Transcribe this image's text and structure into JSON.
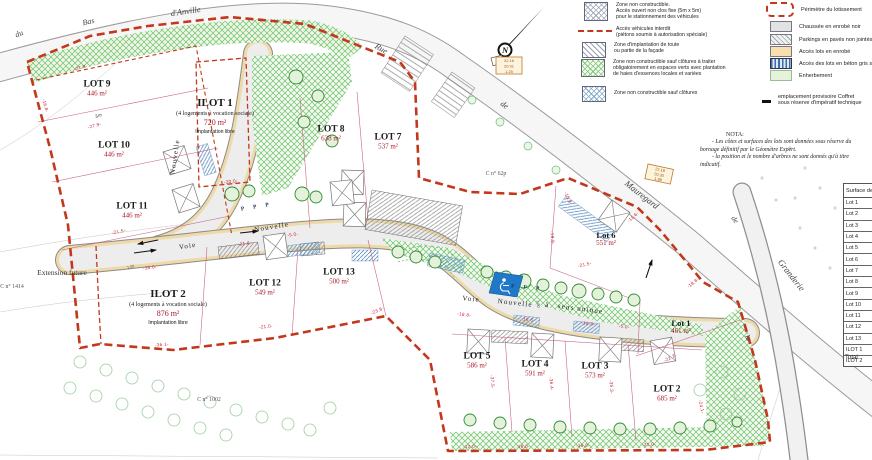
{
  "colors": {
    "perimeter_red": "#c3381c",
    "dimension_red": "#c62333",
    "area_red": "#a81828",
    "vegetation_green": "#6fbf6f",
    "access_blue": "#5b8fc0",
    "road_gray": "#ededed",
    "access_tan": "#eed9a8",
    "parking_blue": "#1f78c8"
  },
  "compass": {
    "n": "N"
  },
  "streets": {
    "du": "du",
    "bas": "Bas",
    "danville": "d'Anville",
    "rue": "Rue",
    "de": "de",
    "mauregard": "Mauregard",
    "de2": "de",
    "la": "la",
    "granderie": "Granderie"
  },
  "road_labels": {
    "voie_a": "Voie",
    "nouvelle_a": "Nouvelle",
    "nouvelle_vert": "Nouvelle",
    "voie_b": "Voie",
    "nouvelle_b": "Nouvelle",
    "a": "à",
    "sens": "sens",
    "unique": "unique",
    "p_row1": "P P P",
    "p_row2": "P P P",
    "d100a": "1.00",
    "d100b": "1.00"
  },
  "lots": {
    "lot1": {
      "name": "Lot 1",
      "area": "461 m²"
    },
    "lot2": {
      "name": "LOT 2",
      "area": "685 m²"
    },
    "lot3": {
      "name": "LOT 3",
      "area": "573 m²"
    },
    "lot4": {
      "name": "LOT 4",
      "area": "591 m²"
    },
    "lot5": {
      "name": "LOT 5",
      "area": "586 m²"
    },
    "lot6": {
      "name": "Lot 6",
      "area": "551 m²"
    },
    "lot7": {
      "name": "LOT 7",
      "area": "537 m²"
    },
    "lot8": {
      "name": "LOT 8",
      "area": "638 m²"
    },
    "lot9": {
      "name": "LOT 9",
      "area": "446 m²"
    },
    "lot10": {
      "name": "LOT 10",
      "area": "446 m²"
    },
    "lot11": {
      "name": "LOT 11",
      "area": "446 m²"
    },
    "lot12": {
      "name": "LOT 12",
      "area": "549 m²"
    },
    "lot13": {
      "name": "LOT 13",
      "area": "500 m²"
    },
    "ilot1": {
      "name": "ILOT 1",
      "sub": "(4 logements à vocation sociale)",
      "area": "720 m²",
      "note": "Implantation libre"
    },
    "ilot2": {
      "name": "ILOT 2",
      "sub": "(4 logements à vocation sociale)",
      "area": "876 m²",
      "note": "Implantation libre"
    }
  },
  "parcels": {
    "c1414": "C n° 1414",
    "c1002": "C n° 1002",
    "c62p": "C n° 62p",
    "extension": "Extension future"
  },
  "dims": [
    "-27.9-",
    "-27.9-",
    "-16.8-",
    "3m",
    "-21.5-",
    "-36.0-",
    "-20.0-",
    "-21.6-",
    "-5.0-",
    "-21.0-",
    "-23.8-",
    "-36.1-",
    "-12.0-",
    "-16.0-",
    "-16.0-",
    "-21.0-",
    "-37.5-",
    "-36.4-",
    "-35.3-",
    "-22.2-",
    "-24.1-",
    "-15.8-",
    "-11.6-",
    "-18.8-",
    "-21.5-",
    "-18.8-",
    "-16.6-",
    "-5.0-",
    "-16.6-",
    "-18.8-"
  ],
  "elev1": [
    "22.16",
    "20.91",
    "1.25"
  ],
  "elev2": [
    "22.18",
    "20.30",
    "1.88"
  ],
  "legend_zones": [
    {
      "lines": [
        "Zone non constructible.",
        "Accès ouvert non clos fixe (5m x 5m)",
        "pour le stationnement des véhicules"
      ]
    },
    {
      "lines": [
        "Accès véhicules interdit",
        "(piétons soumis à autorisation spéciale)"
      ]
    },
    {
      "lines": [
        "Zone d'implantation de toute",
        "ou partie de la façade"
      ]
    },
    {
      "lines": [
        "Zone non constructible sauf clôtures à traiter",
        "obligatoirement en espaces verts avec plantation",
        "de haies d'essences locales et variées"
      ]
    },
    {
      "lines": [
        "Zone non constructible sauf clôtures"
      ]
    }
  ],
  "legend_surfaces": {
    "items": [
      "Périmètre du lotissement",
      "Chaussée en enrobé noir",
      "Parkings en pavés non jointés",
      "Accès lots en enrobé",
      "Accès des lots en béton gris strié",
      "Enherbement"
    ],
    "note1": "emplacement provisoire Coffret",
    "note2": "sous réserve d'impératif technique"
  },
  "nota": {
    "title": "NOTA:",
    "l1": "- Les côtes et surfaces des lots sont données sous réserve du",
    "l2": "bornage définitif par le Géomètre Expert.",
    "l3": "- la position et le nombre d'arbres ne sont donnés qu'à titre",
    "l4": "indicatif."
  },
  "table": {
    "header": "Surface de",
    "rows": [
      "Lot 1",
      "Lot 2",
      "Lot 3",
      "Lot 4",
      "Lot 5",
      "Lot 6",
      "Lot 7",
      "Lot 8",
      "Lot 9",
      "Lot 10",
      "Lot 11",
      "Lot 12",
      "Lot 13",
      "ILOT 1",
      "ILOT 2"
    ],
    "total": "Total:"
  }
}
